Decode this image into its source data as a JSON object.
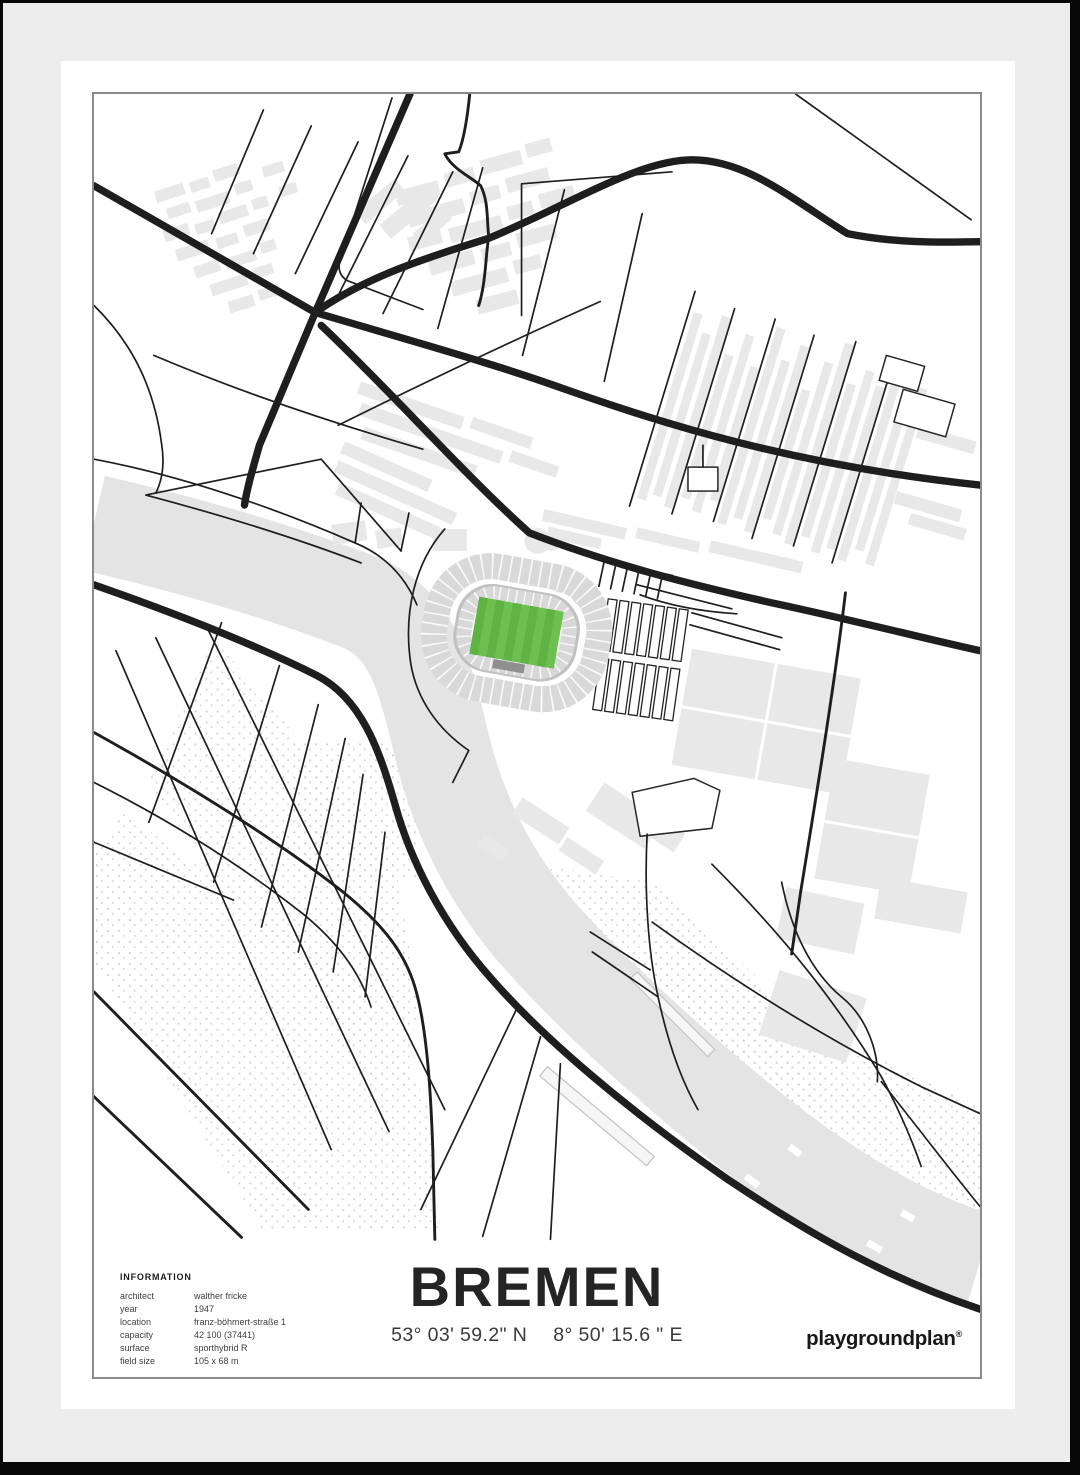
{
  "poster": {
    "title": "BREMEN",
    "coordinates": {
      "north": "53° 03' 59.2\" N",
      "east": "8° 50' 15.6 \" E"
    },
    "brand": {
      "name": "playgroundplan",
      "mark": "®"
    },
    "info": {
      "heading": "INFORMATION",
      "rows": [
        {
          "label": "architect",
          "value": "walther fricke"
        },
        {
          "label": "year",
          "value": "1947"
        },
        {
          "label": "location",
          "value": "franz-böhmert-straße 1"
        },
        {
          "label": "capacity",
          "value": "42 100 (37441)"
        },
        {
          "label": "surface",
          "value": "sporthybrid R"
        },
        {
          "label": "field size",
          "value": "105 x 68 m"
        }
      ]
    }
  },
  "colors": {
    "frame_wall": "#ededed",
    "poster": "#ffffff",
    "map_border": "#8a8a8a",
    "road": "#1e1e1e",
    "building": "#e8e8e8",
    "river": "#e4e4e4",
    "stand": "#d9d9d9",
    "stand_mid": "#c1c1c1",
    "pitch_green": "#6cc04f",
    "pitch_stripe": "#5eb342",
    "dark_stand": "#8f8f8f",
    "dot": "#d2d2d2",
    "text": "#2b2b2b"
  }
}
